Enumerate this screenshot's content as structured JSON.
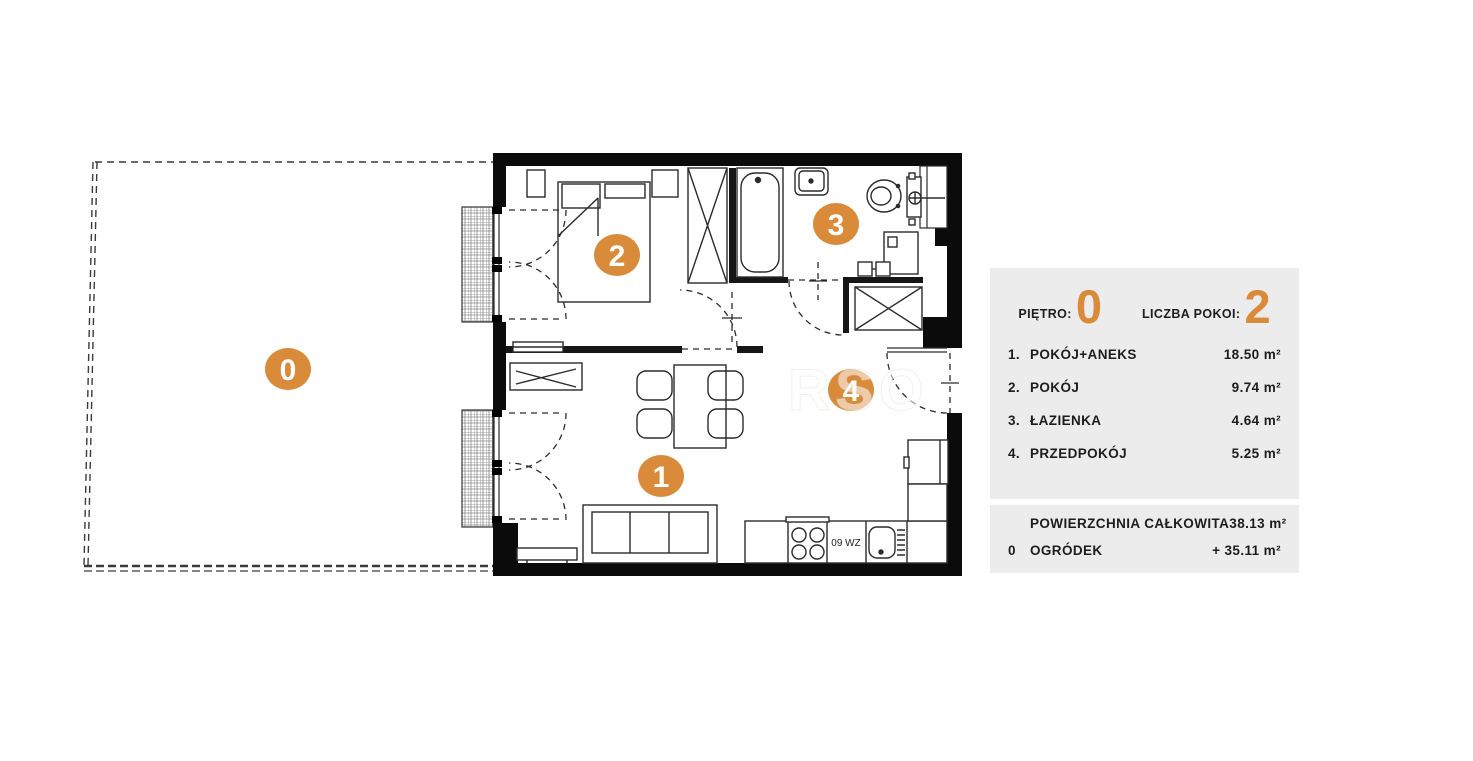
{
  "panel": {
    "floor": {
      "label": "PIĘTRO:",
      "value": "0"
    },
    "rooms_count": {
      "label": "LICZBA POKOI:",
      "value": "2"
    },
    "room_rows": [
      {
        "num": "1.",
        "name": "POKÓJ+ANEKS",
        "area": "18.50 m²"
      },
      {
        "num": "2.",
        "name": "POKÓJ",
        "area": "9.74 m²"
      },
      {
        "num": "3.",
        "name": "ŁAZIENKA",
        "area": "4.64 m²"
      },
      {
        "num": "4.",
        "name": "PRZEDPOKÓJ",
        "area": "5.25 m²"
      }
    ],
    "summary_rows": [
      {
        "num": "",
        "name": "POWIERZCHNIA CAŁKOWITA",
        "area": "38.13 m²"
      },
      {
        "num": "0",
        "name": "OGRÓDEK",
        "area": "+  35.11 m²"
      }
    ]
  },
  "plan": {
    "room_markers": [
      {
        "id": "0"
      },
      {
        "id": "1"
      },
      {
        "id": "2"
      },
      {
        "id": "3"
      },
      {
        "id": "4"
      }
    ],
    "kitchen_unit_label": "09 WZ",
    "watermark": "RSO"
  },
  "colors": {
    "accent_orange": "#D98B3A",
    "panel_background": "#ECECEC",
    "wall_black": "#0B0B0B",
    "line_dark": "#2B2B2B"
  }
}
